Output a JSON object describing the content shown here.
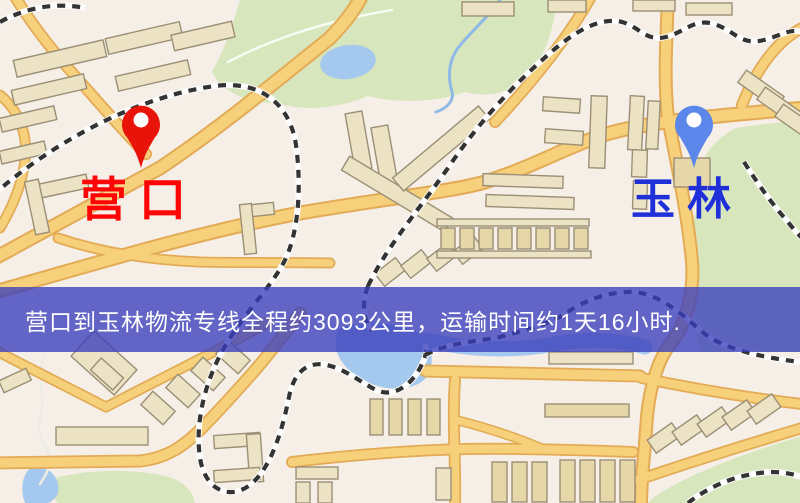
{
  "map": {
    "origin_label": "营口",
    "destination_label": "玉林",
    "origin_label_color": "#fe0505",
    "destination_label_color": "#2030d8",
    "origin_pin_color": "#e91409",
    "destination_pin_color": "#5b87ea"
  },
  "banner": {
    "text": "营口到玉林物流专线全程约3093公里，运输时间约1天16小时.",
    "origin": "营口",
    "destination": "玉林",
    "distance": "约3093公里",
    "duration": "约1天16小时",
    "background_color": "#3a3ebc",
    "text_color": "#ffffff"
  }
}
